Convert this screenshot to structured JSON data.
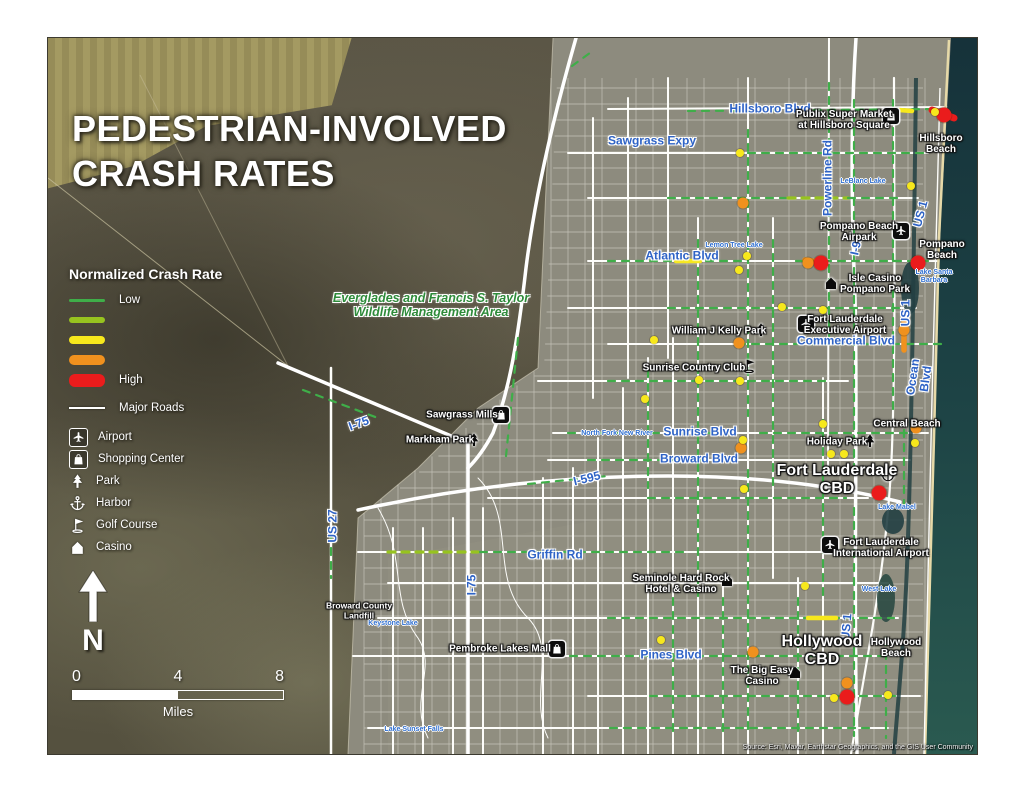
{
  "title": {
    "line1": "PEDESTRIAN-INVOLVED",
    "line2": "CRASH RATES"
  },
  "north_letter": "N",
  "scalebar": {
    "ticks": [
      "0",
      "4",
      "8"
    ],
    "unit": "Miles"
  },
  "attribution": "Source: Esri, Maxar, Earthstar Geographics, and the GIS User Community",
  "legend": {
    "heading": "Normalized Crash Rate",
    "rates": [
      {
        "label": "Low",
        "color": "#3fae49",
        "thickness": 3
      },
      {
        "label": "",
        "color": "#97c31f",
        "thickness": 6
      },
      {
        "label": "",
        "color": "#f7e81c",
        "thickness": 8
      },
      {
        "label": "",
        "color": "#f0911e",
        "thickness": 10
      },
      {
        "label": "High",
        "color": "#ea1c1c",
        "thickness": 13
      }
    ],
    "roads": {
      "label": "Major Roads",
      "color": "#ffffff"
    },
    "pois": [
      {
        "type": "airport",
        "label": "Airport",
        "boxed": true
      },
      {
        "type": "shopping",
        "label": "Shopping Center",
        "boxed": true
      },
      {
        "type": "park",
        "label": "Park",
        "boxed": false
      },
      {
        "type": "harbor",
        "label": "Harbor",
        "boxed": false
      },
      {
        "type": "golf",
        "label": "Golf Course",
        "boxed": false
      },
      {
        "type": "casino",
        "label": "Casino",
        "boxed": false
      }
    ]
  },
  "map": {
    "area_label": {
      "t": "Everglades and Francis S. Taylor\nWildlife Management Area",
      "x": 383,
      "y": 267
    },
    "road_labels": [
      {
        "t": "Hillsboro Blvd",
        "x": 722,
        "y": 71
      },
      {
        "t": "Sawgrass Expy",
        "x": 604,
        "y": 103
      },
      {
        "t": "Powerline Rd",
        "x": 780,
        "y": 140,
        "r": -90
      },
      {
        "t": "US 1",
        "x": 873,
        "y": 176,
        "r": -75
      },
      {
        "t": "I-95",
        "x": 809,
        "y": 207,
        "r": -78
      },
      {
        "t": "Atlantic Blvd",
        "x": 634,
        "y": 218
      },
      {
        "t": "US 1",
        "x": 858,
        "y": 275,
        "r": -90
      },
      {
        "t": "Commercial Blvd",
        "x": 798,
        "y": 303
      },
      {
        "t": "Ocean Blvd",
        "x": 872,
        "y": 340,
        "r": -82
      },
      {
        "t": "I-75",
        "x": 311,
        "y": 386,
        "r": -20
      },
      {
        "t": "Sunrise Blvd",
        "x": 652,
        "y": 394
      },
      {
        "t": "Broward Blvd",
        "x": 651,
        "y": 421
      },
      {
        "t": "I-595",
        "x": 539,
        "y": 441,
        "r": -14
      },
      {
        "t": "US 27",
        "x": 285,
        "y": 488,
        "r": -90
      },
      {
        "t": "Griffin Rd",
        "x": 507,
        "y": 517
      },
      {
        "t": "I-75",
        "x": 424,
        "y": 547,
        "r": -90
      },
      {
        "t": "US 1",
        "x": 799,
        "y": 589,
        "r": -85
      },
      {
        "t": "Pines Blvd",
        "x": 623,
        "y": 617
      }
    ],
    "place_labels": [
      {
        "t": "Publix Super Market\nat Hillsboro Square",
        "x": 796,
        "y": 82
      },
      {
        "t": "Hillsboro Beach",
        "x": 893,
        "y": 106
      },
      {
        "t": "Pompano Beach\nAirpark",
        "x": 811,
        "y": 194
      },
      {
        "t": "Pompano Beach",
        "x": 894,
        "y": 212
      },
      {
        "t": "Isle Casino\nPompano Park",
        "x": 827,
        "y": 246
      },
      {
        "t": "William J Kelly Park",
        "x": 671,
        "y": 293
      },
      {
        "t": "Fort Lauderdale\nExecutive Airport",
        "x": 797,
        "y": 287
      },
      {
        "t": "Sunrise Country Club",
        "x": 646,
        "y": 330
      },
      {
        "t": "Sawgrass Mills",
        "x": 414,
        "y": 377
      },
      {
        "t": "Markham Park",
        "x": 392,
        "y": 402
      },
      {
        "t": "Central Beach",
        "x": 859,
        "y": 386
      },
      {
        "t": "Holiday Park",
        "x": 789,
        "y": 404
      },
      {
        "t": "Fort Lauderdale\nCBD",
        "x": 789,
        "y": 442,
        "s": "big"
      },
      {
        "t": "Fort Lauderdale\nInternational Airport",
        "x": 833,
        "y": 510
      },
      {
        "t": "Seminole Hard Rock\nHotel & Casino",
        "x": 633,
        "y": 546
      },
      {
        "t": "Broward County\nLandfill",
        "x": 311,
        "y": 573,
        "s": "small"
      },
      {
        "t": "Pembroke Lakes Mall",
        "x": 452,
        "y": 611
      },
      {
        "t": "Hollywood\nCBD",
        "x": 774,
        "y": 613,
        "s": "big"
      },
      {
        "t": "Hollywood Beach",
        "x": 848,
        "y": 610
      },
      {
        "t": "The Big Easy\nCasino",
        "x": 714,
        "y": 638
      }
    ],
    "lake_labels": [
      {
        "t": "LeBlanc Lake",
        "x": 815,
        "y": 144
      },
      {
        "t": "Lemon Tree Lake",
        "x": 686,
        "y": 208
      },
      {
        "t": "Lake Santa Barbara",
        "x": 886,
        "y": 239
      },
      {
        "t": "North Fork New River",
        "x": 569,
        "y": 396
      },
      {
        "t": "Lake Mabel",
        "x": 849,
        "y": 470
      },
      {
        "t": "West Lake",
        "x": 831,
        "y": 552
      },
      {
        "t": "Keystone Lake",
        "x": 345,
        "y": 586
      },
      {
        "t": "Lake Sunset Falls",
        "x": 366,
        "y": 692
      }
    ],
    "poi_icons": [
      {
        "type": "shopping",
        "x": 843,
        "y": 78
      },
      {
        "type": "airport",
        "x": 853,
        "y": 193
      },
      {
        "type": "casino",
        "x": 783,
        "y": 245
      },
      {
        "type": "park",
        "x": 713,
        "y": 292
      },
      {
        "type": "airport",
        "x": 758,
        "y": 286
      },
      {
        "type": "golf",
        "x": 701,
        "y": 328
      },
      {
        "type": "shopping",
        "x": 453,
        "y": 377
      },
      {
        "type": "park",
        "x": 426,
        "y": 402
      },
      {
        "type": "park",
        "x": 822,
        "y": 403
      },
      {
        "type": "harbor",
        "x": 840,
        "y": 437
      },
      {
        "type": "airport",
        "x": 782,
        "y": 507
      },
      {
        "type": "casino",
        "x": 679,
        "y": 542
      },
      {
        "type": "shopping",
        "x": 509,
        "y": 611
      },
      {
        "type": "casino",
        "x": 747,
        "y": 634
      }
    ],
    "markers": [
      {
        "x": 896,
        "y": 77,
        "l": 5
      },
      {
        "x": 773,
        "y": 225,
        "l": 5
      },
      {
        "x": 870,
        "y": 225,
        "l": 5
      },
      {
        "x": 831,
        "y": 455,
        "l": 5
      },
      {
        "x": 799,
        "y": 659,
        "l": 5
      },
      {
        "x": 695,
        "y": 165,
        "l": 4
      },
      {
        "x": 760,
        "y": 225,
        "l": 4
      },
      {
        "x": 691,
        "y": 305,
        "l": 4
      },
      {
        "x": 856,
        "y": 292,
        "l": 4
      },
      {
        "x": 868,
        "y": 390,
        "l": 4
      },
      {
        "x": 693,
        "y": 410,
        "l": 4
      },
      {
        "x": 705,
        "y": 614,
        "l": 4
      },
      {
        "x": 799,
        "y": 645,
        "l": 4
      },
      {
        "x": 887,
        "y": 74,
        "l": 3
      },
      {
        "x": 692,
        "y": 115,
        "l": 3
      },
      {
        "x": 863,
        "y": 148,
        "l": 3
      },
      {
        "x": 699,
        "y": 218,
        "l": 3
      },
      {
        "x": 691,
        "y": 232,
        "l": 3
      },
      {
        "x": 734,
        "y": 269,
        "l": 3
      },
      {
        "x": 775,
        "y": 272,
        "l": 3
      },
      {
        "x": 606,
        "y": 302,
        "l": 3
      },
      {
        "x": 651,
        "y": 342,
        "l": 3
      },
      {
        "x": 692,
        "y": 343,
        "l": 3
      },
      {
        "x": 597,
        "y": 361,
        "l": 3
      },
      {
        "x": 695,
        "y": 402,
        "l": 3
      },
      {
        "x": 775,
        "y": 386,
        "l": 3
      },
      {
        "x": 783,
        "y": 416,
        "l": 3
      },
      {
        "x": 796,
        "y": 416,
        "l": 3
      },
      {
        "x": 696,
        "y": 451,
        "l": 3
      },
      {
        "x": 867,
        "y": 405,
        "l": 3
      },
      {
        "x": 757,
        "y": 548,
        "l": 3
      },
      {
        "x": 613,
        "y": 602,
        "l": 3
      },
      {
        "x": 786,
        "y": 660,
        "l": 3
      },
      {
        "x": 840,
        "y": 657,
        "l": 3
      }
    ],
    "crash_segments": [
      [
        640,
        73,
        898,
        71,
        1
      ],
      [
        700,
        115,
        878,
        115,
        1
      ],
      [
        620,
        160,
        738,
        160,
        1
      ],
      [
        740,
        160,
        800,
        160,
        2
      ],
      [
        800,
        160,
        850,
        160,
        1
      ],
      [
        560,
        223,
        696,
        223,
        1
      ],
      [
        748,
        223,
        880,
        223,
        1
      ],
      [
        620,
        270,
        858,
        270,
        1
      ],
      [
        690,
        306,
        900,
        306,
        1
      ],
      [
        560,
        343,
        778,
        343,
        1
      ],
      [
        520,
        395,
        688,
        395,
        1
      ],
      [
        712,
        395,
        862,
        395,
        1
      ],
      [
        540,
        422,
        688,
        422,
        1
      ],
      [
        600,
        460,
        798,
        460,
        1
      ],
      [
        340,
        514,
        430,
        514,
        2
      ],
      [
        432,
        514,
        640,
        514,
        1
      ],
      [
        560,
        580,
        846,
        580,
        1
      ],
      [
        522,
        618,
        838,
        618,
        1
      ],
      [
        602,
        658,
        848,
        658,
        1
      ],
      [
        562,
        690,
        828,
        690,
        1
      ],
      [
        781,
        45,
        781,
        298,
        1
      ],
      [
        806,
        62,
        806,
        428,
        1
      ],
      [
        806,
        470,
        806,
        698,
        1
      ],
      [
        845,
        62,
        845,
        228,
        1
      ],
      [
        845,
        252,
        845,
        378,
        1
      ],
      [
        725,
        202,
        725,
        448,
        1
      ],
      [
        700,
        92,
        700,
        378,
        1
      ],
      [
        700,
        432,
        700,
        698,
        1
      ],
      [
        650,
        202,
        650,
        558,
        1
      ],
      [
        675,
        560,
        675,
        700,
        1
      ],
      [
        750,
        560,
        750,
        700,
        1
      ],
      [
        775,
        382,
        775,
        558,
        1
      ],
      [
        600,
        332,
        600,
        450,
        1
      ],
      [
        625,
        560,
        625,
        700,
        1
      ],
      [
        856,
        392,
        856,
        468,
        1
      ],
      [
        470,
        300,
        458,
        418,
        1
      ],
      [
        283,
        496,
        283,
        540,
        1
      ],
      [
        255,
        352,
        330,
        380,
        1
      ],
      [
        480,
        446,
        560,
        438,
        1
      ],
      [
        838,
        600,
        838,
        700,
        1
      ],
      [
        524,
        28,
        546,
        12,
        1
      ],
      [
        838,
        71,
        864,
        73,
        3
      ],
      [
        628,
        223,
        652,
        223,
        3
      ],
      [
        760,
        580,
        788,
        580,
        3
      ],
      [
        856,
        282,
        856,
        312,
        4
      ],
      [
        757,
        222,
        770,
        224,
        4
      ],
      [
        884,
        72,
        906,
        80,
        5
      ]
    ]
  }
}
